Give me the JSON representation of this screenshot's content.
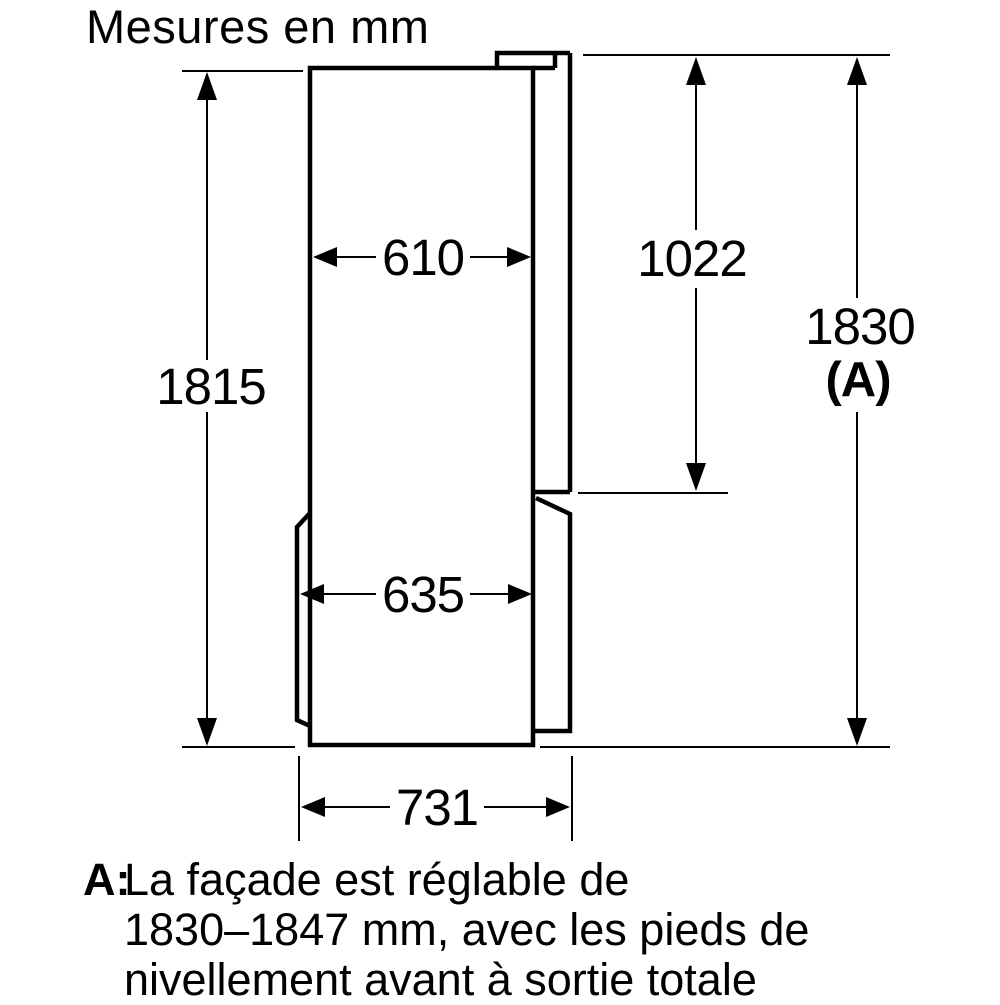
{
  "title": "Mesures en mm",
  "diagram": {
    "type": "dimension-drawing",
    "subject": "refrigerator-side-profile",
    "unit": "mm",
    "labels": {
      "cabinet_height": "1815",
      "cabinet_depth": "610",
      "upper_door_height": "1022",
      "appliance_height": "1830",
      "appliance_height_ref": "(A)",
      "depth_without_door": "635",
      "total_depth": "731"
    }
  },
  "footnote": {
    "marker": "A:",
    "lines": [
      "La façade est réglable de",
      "1830–1847 mm, avec les pieds de",
      "nivellement avant à sortie totale"
    ]
  },
  "colors": {
    "ink": "#000000",
    "background": "#ffffff"
  }
}
